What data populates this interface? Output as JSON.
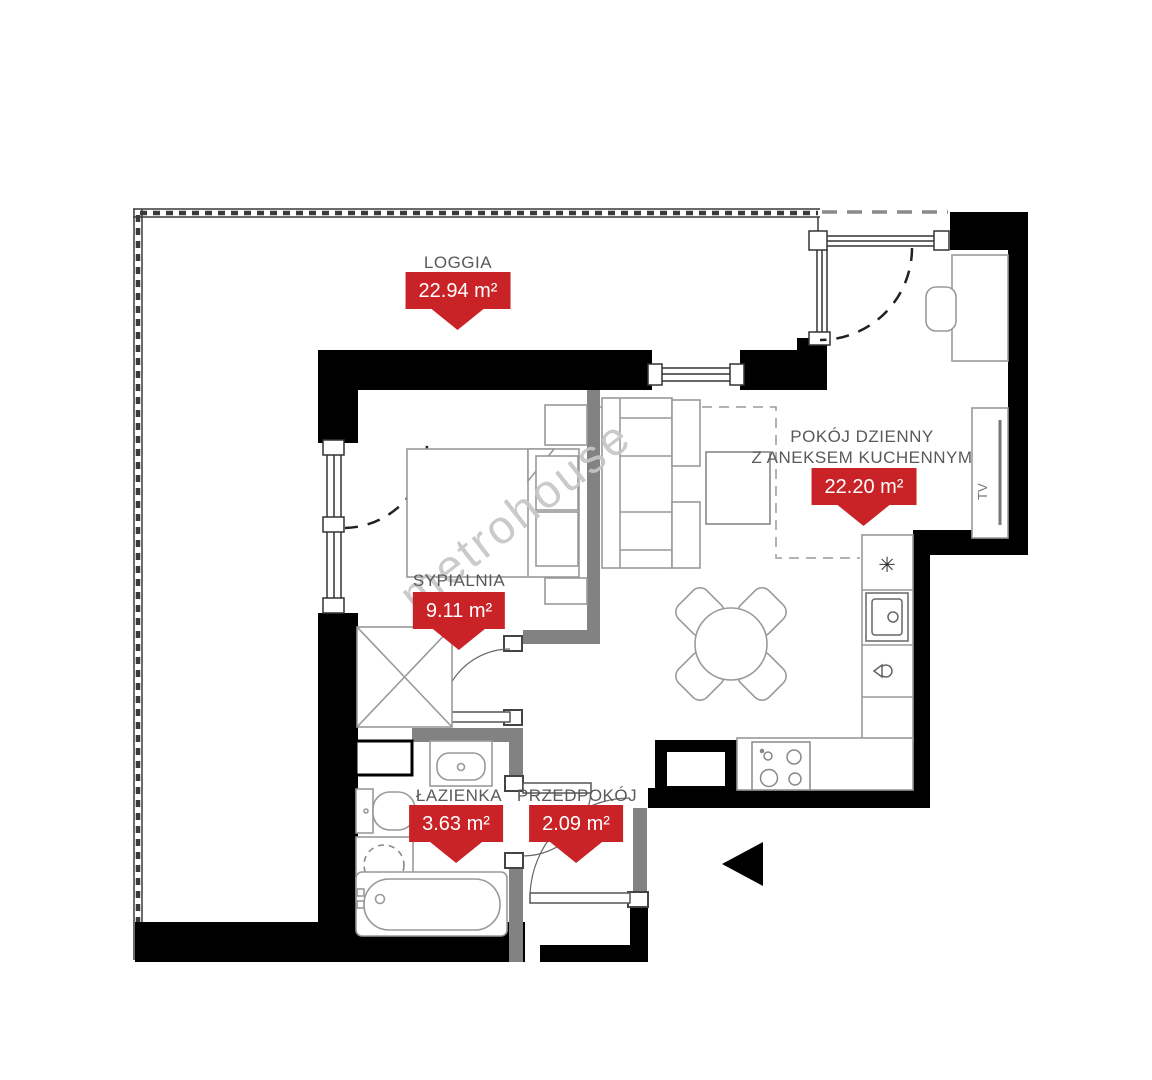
{
  "plan": {
    "watermark": "metrohouse",
    "rooms": [
      {
        "name": "LOGGIA",
        "area": "22.94 m²"
      },
      {
        "name": "POKÓJ DZIENNY\nZ ANEKSEM KUCHENNYM",
        "area": "22.20 m²"
      },
      {
        "name": "SYPIALNIA",
        "area": "9.11 m²"
      },
      {
        "name": "ŁAZIENKA",
        "area": "3.63 m²"
      },
      {
        "name": "PRZEDPOKÓJ",
        "area": "2.09 m²"
      }
    ],
    "icons": {
      "fridge_symbol": "✳",
      "tv_label": "TV"
    },
    "colors": {
      "badge_red": "#c92227",
      "label_gray": "#58595b",
      "wall_black": "#000000",
      "interior_wall_gray": "#828282",
      "watermark_gray": "#c6c6c6"
    }
  }
}
